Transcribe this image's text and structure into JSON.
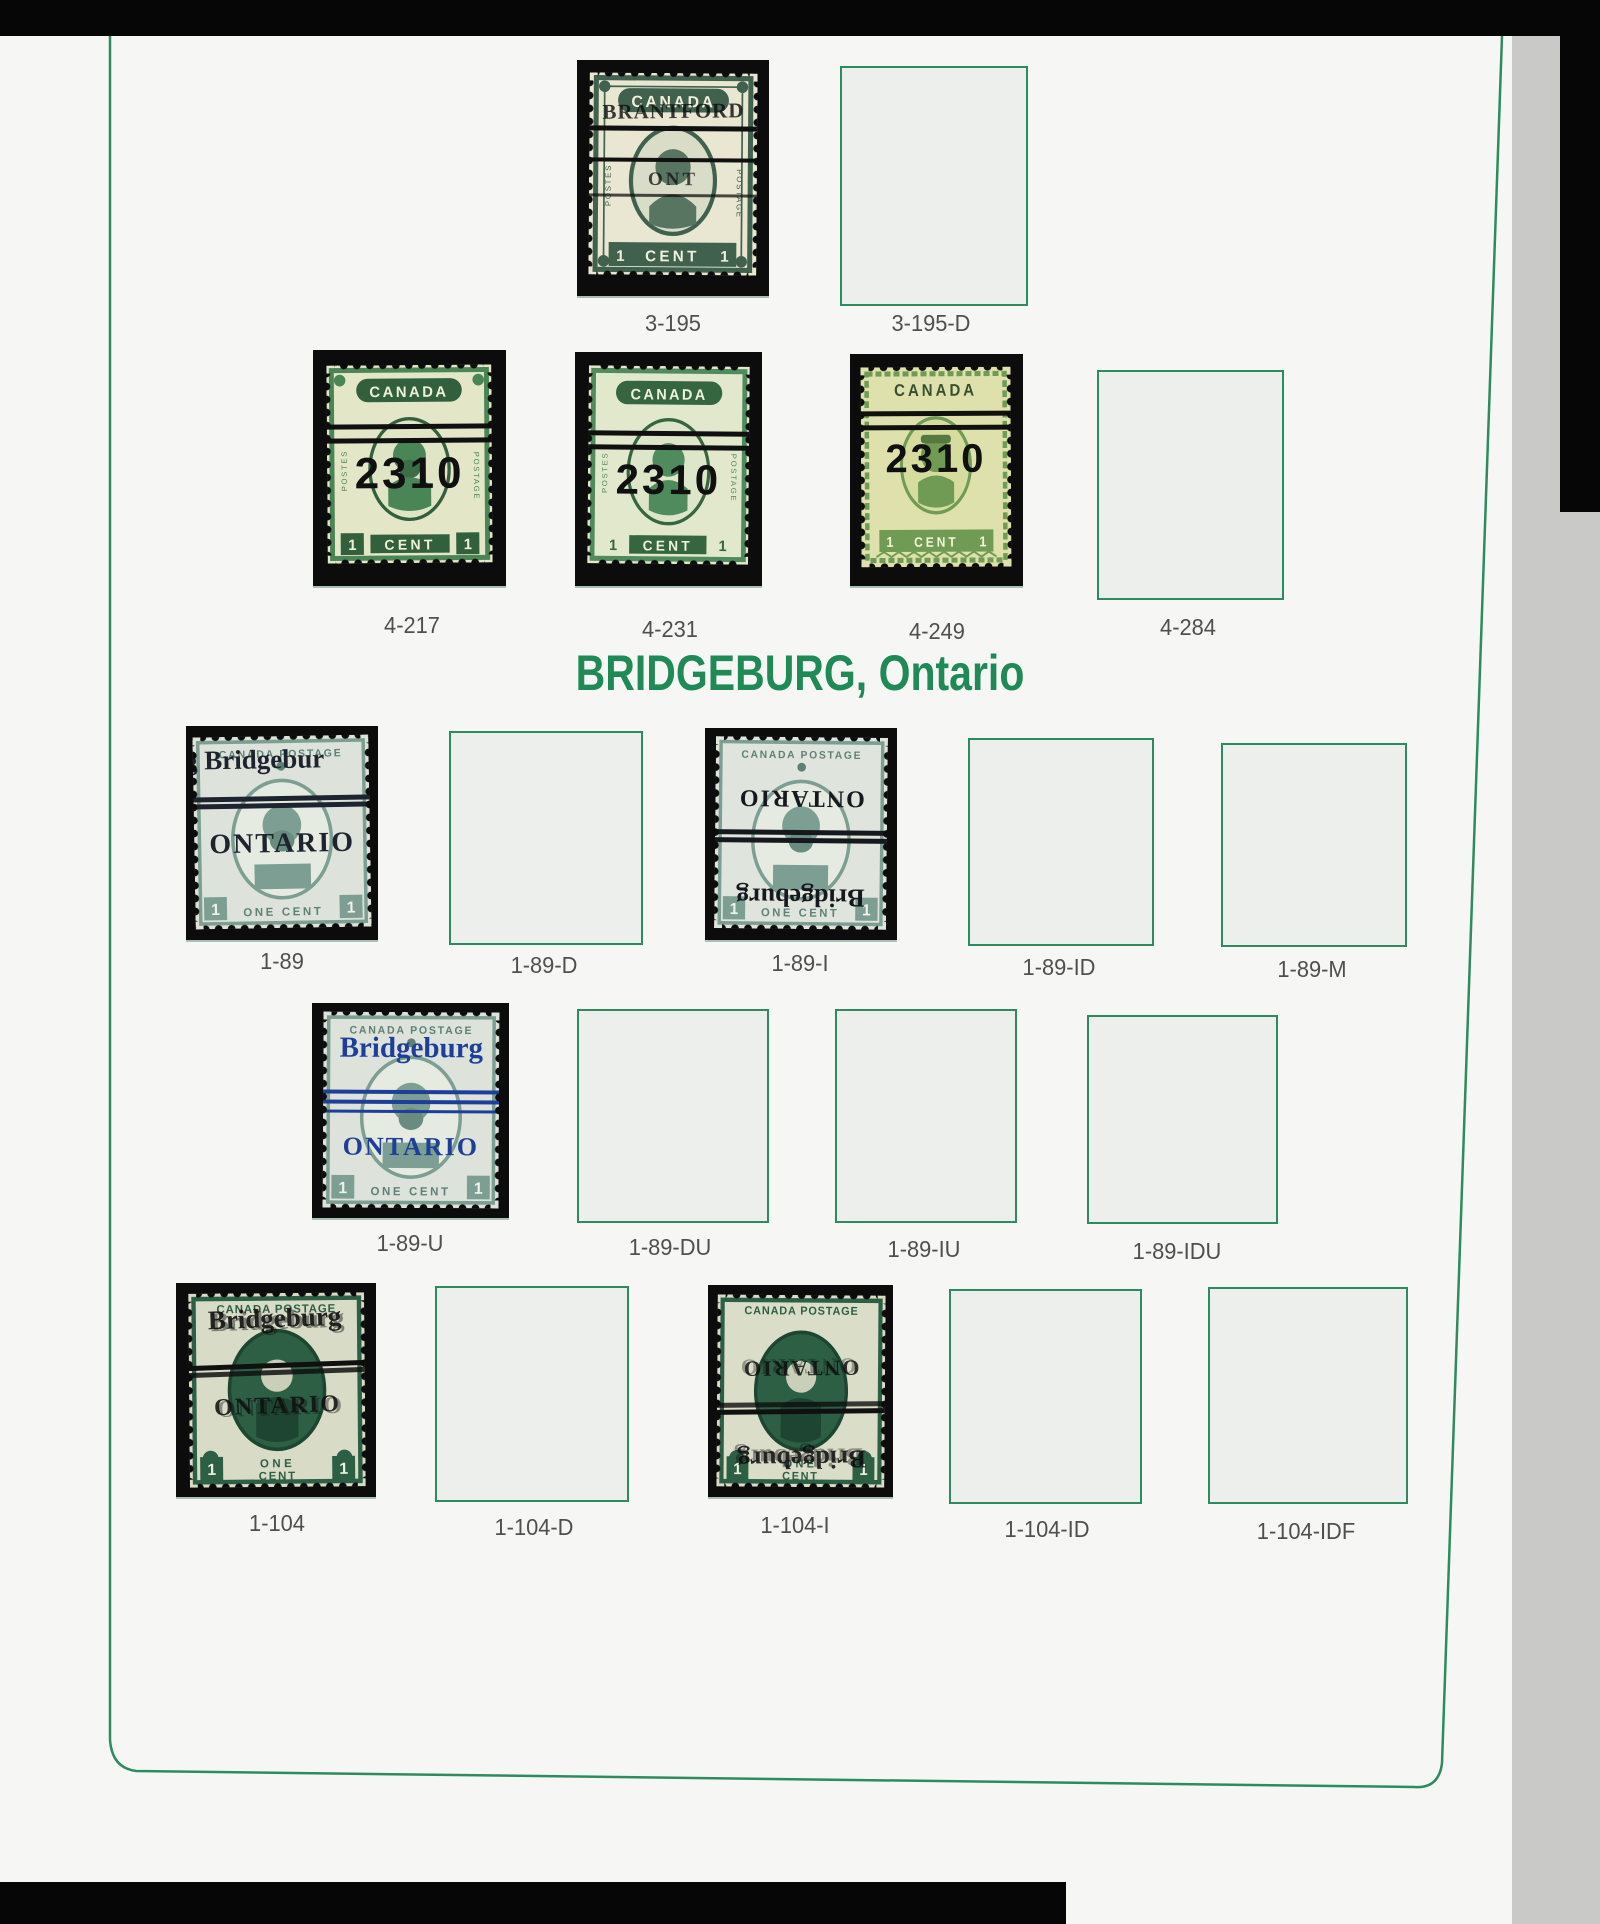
{
  "scan": {
    "top_partial_header_text": "Ontario",
    "section_title": "BRIDGEBURG, Ontario"
  },
  "colors": {
    "frame_green": "#2e8b5f",
    "header_green": "#1f8a56",
    "label_gray": "#4f4f4f",
    "overprint_black": "#101010",
    "overprint_blue": "#1d3f98"
  },
  "labels": {
    "3-195": "3-195",
    "3-195-D": "3-195-D",
    "4-217": "4-217",
    "4-231": "4-231",
    "4-249": "4-249",
    "4-284": "4-284",
    "1-89": "1-89",
    "1-89-D": "1-89-D",
    "1-89-I": "1-89-I",
    "1-89-ID": "1-89-ID",
    "1-89-M": "1-89-M",
    "1-89-U": "1-89-U",
    "1-89-DU": "1-89-DU",
    "1-89-IU": "1-89-IU",
    "1-89-IDU": "1-89-IDU",
    "1-104": "1-104",
    "1-104-D": "1-104-D",
    "1-104-I": "1-104-I",
    "1-104-ID": "1-104-ID",
    "1-104-IDF": "1-104-IDF"
  },
  "stamp_text": {
    "canada": "CANADA",
    "canada_postage": "CANADA POSTAGE",
    "postes": "POSTES",
    "postage": "POSTAGE",
    "one": "1",
    "cent": "CENT",
    "one_word": "ONE",
    "one_cent": "ONE CENT",
    "precancel_2310": "2310",
    "bridgeburg": "Bridgeburg",
    "bridgeburg_offset": "g Bridgebur",
    "ontario": "ONTARIO",
    "brantford": "BRANTFORD",
    "ont": "ONT"
  }
}
